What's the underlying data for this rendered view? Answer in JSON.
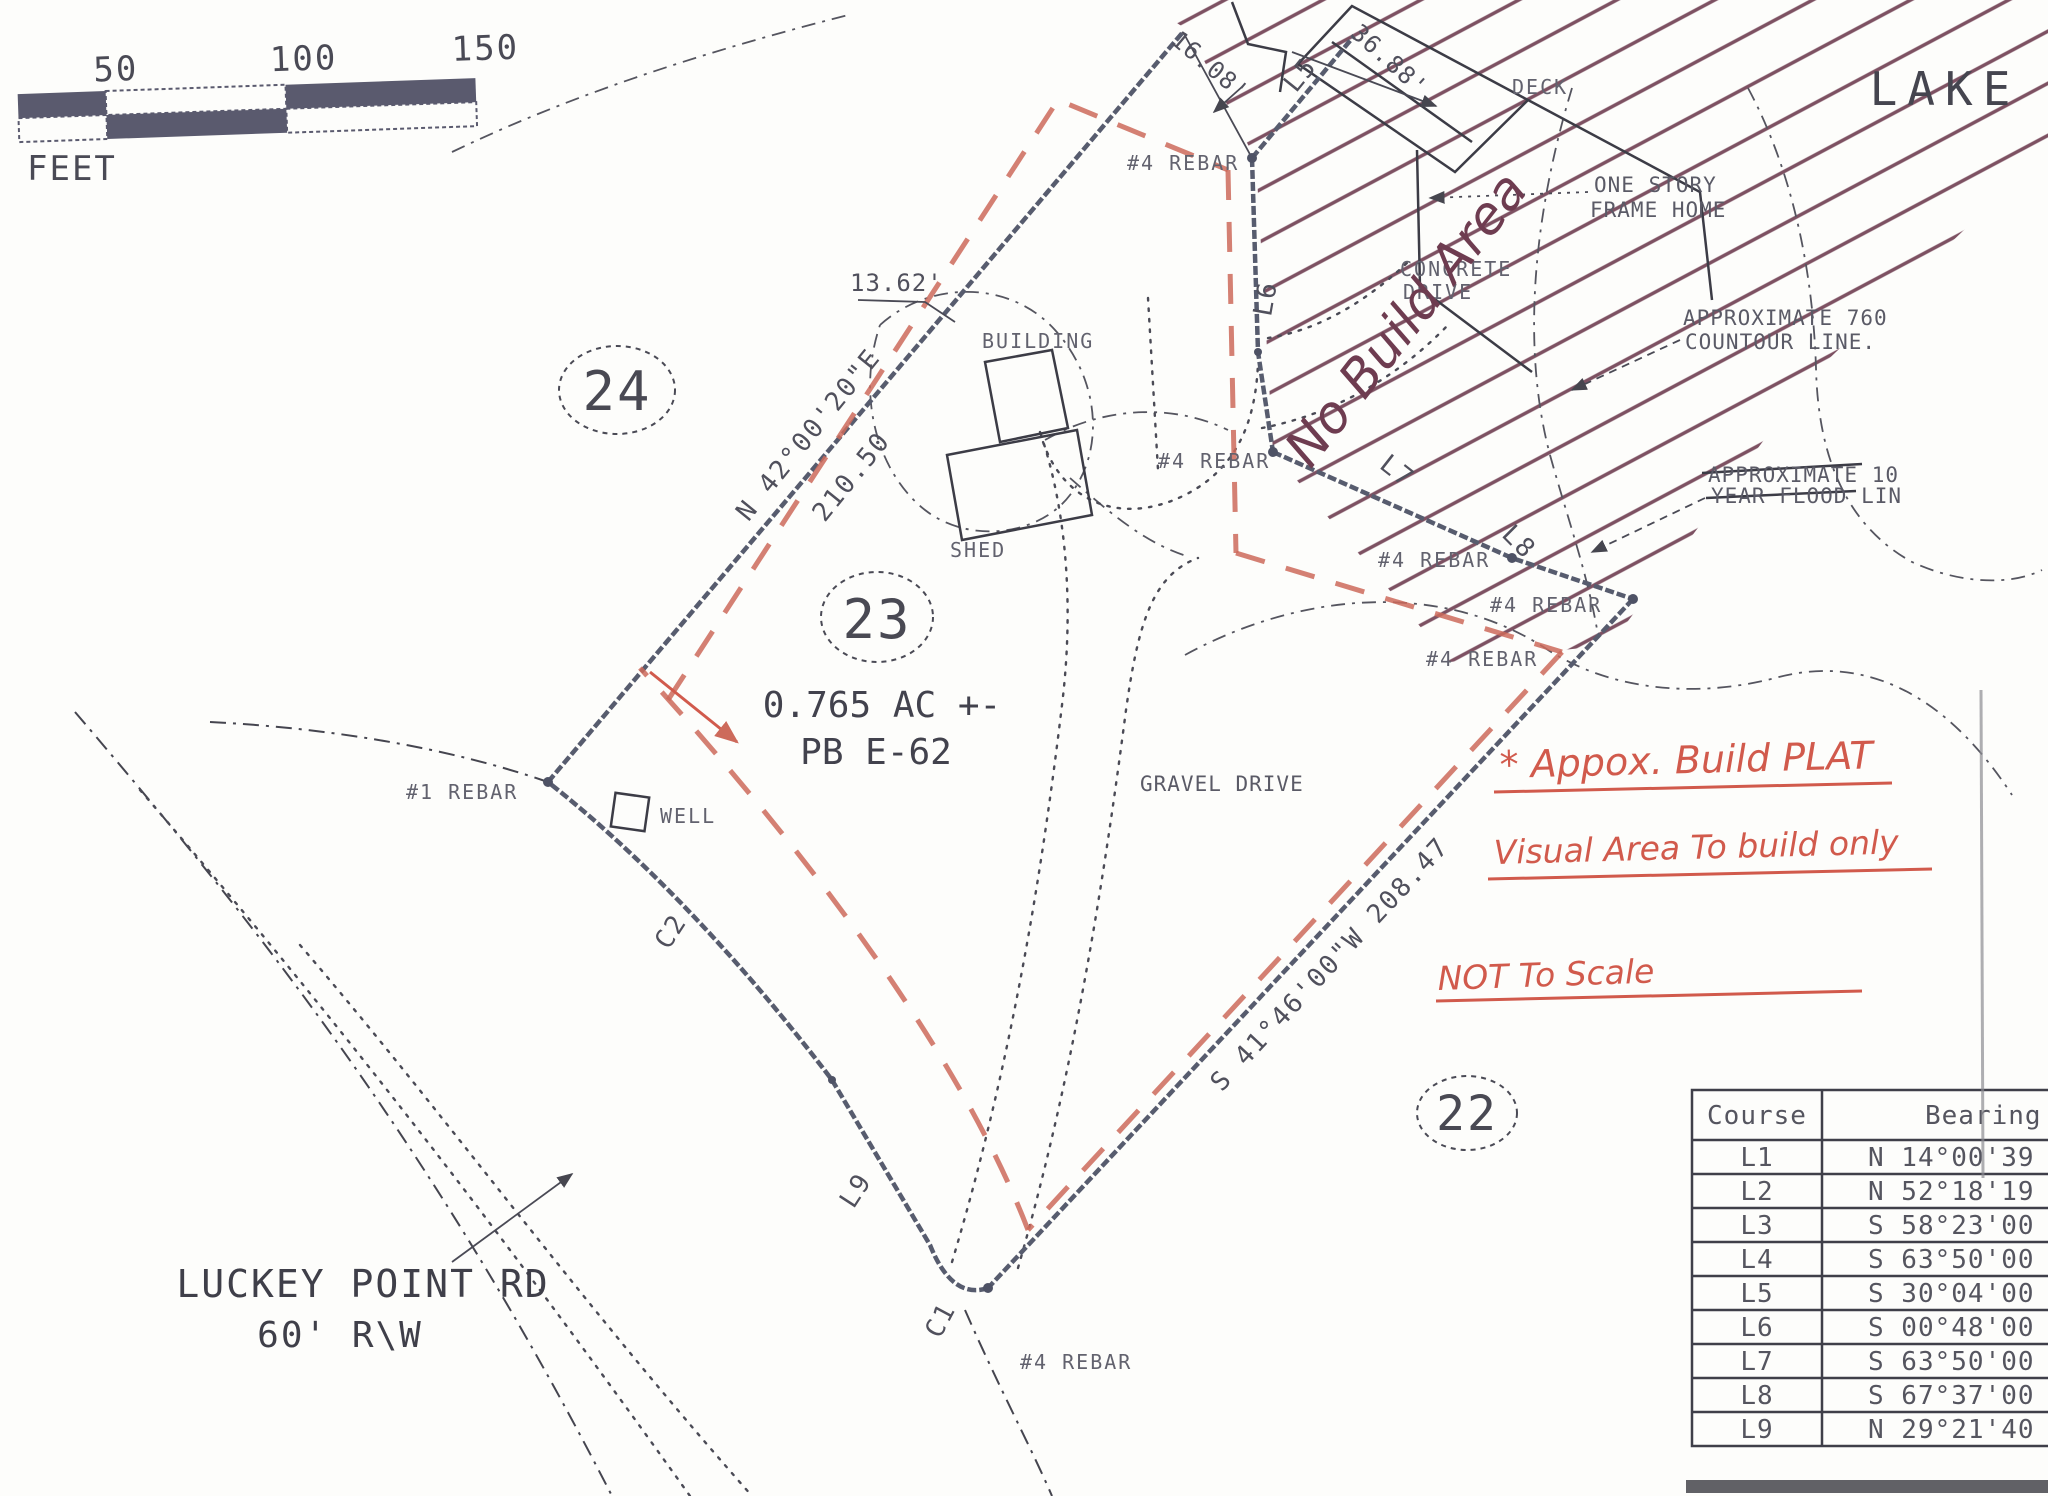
{
  "map": {
    "lake": "LAKE",
    "deck": "DECK",
    "home_line1": "ONE STORY",
    "home_line2": "FRAME HOME",
    "concrete_line1": "CONCRETE",
    "concrete_line2": "DRIVE",
    "contour_line1": "APPROXIMATE 760",
    "contour_line2": "COUNTOUR LINE.",
    "flood_line1": "APPROXIMATE 10",
    "flood_line2": "YEAR FLOOD LIN",
    "building": "BUILDING",
    "shed": "SHED",
    "well": "WELL",
    "gravel_drive": "GRAVEL DRIVE",
    "rebar4": "#4 REBAR",
    "rebar1": "#1 REBAR",
    "lot24": "24",
    "lot23": "23",
    "lot22": "22",
    "area": "0.765 AC +-",
    "plat_book": "PB E-62",
    "bearing_nw": "N 42°00'20\"E",
    "dist_nw": "210.50",
    "bearing_se": "S 41°46'00\"W 208.47",
    "dim_16": "16.08'",
    "dim_36": "36.88'",
    "dim_13": "13.62'",
    "L5": "L5",
    "L6": "L6",
    "L7": "L7",
    "L8": "L8",
    "L9": "L9",
    "C1": "C1",
    "C2": "C2",
    "road_line1": "LUCKEY POINT RD",
    "road_line2": "60' R\\W"
  },
  "scale_bar": {
    "t50": "50",
    "t100": "100",
    "t150": "150",
    "unit": "FEET"
  },
  "annotations": {
    "no_build": "No Build Area",
    "note1": "* Appox. Build PLAT",
    "note2": "Visual Area To build only",
    "note3": "NOT To Scale",
    "pen_red": "#d15a4c",
    "pen_maroon": "#6e3c50"
  },
  "course_table": {
    "headers": [
      "Course",
      "Bearing"
    ],
    "rows": [
      [
        "L1",
        "N 14°00'39"
      ],
      [
        "L2",
        "N 52°18'19"
      ],
      [
        "L3",
        "S 58°23'00"
      ],
      [
        "L4",
        "S 63°50'00"
      ],
      [
        "L5",
        "S 30°04'00"
      ],
      [
        "L6",
        "S 00°48'00"
      ],
      [
        "L7",
        "S 63°50'00"
      ],
      [
        "L8",
        "S 67°37'00"
      ],
      [
        "L9",
        "N 29°21'40"
      ]
    ]
  }
}
